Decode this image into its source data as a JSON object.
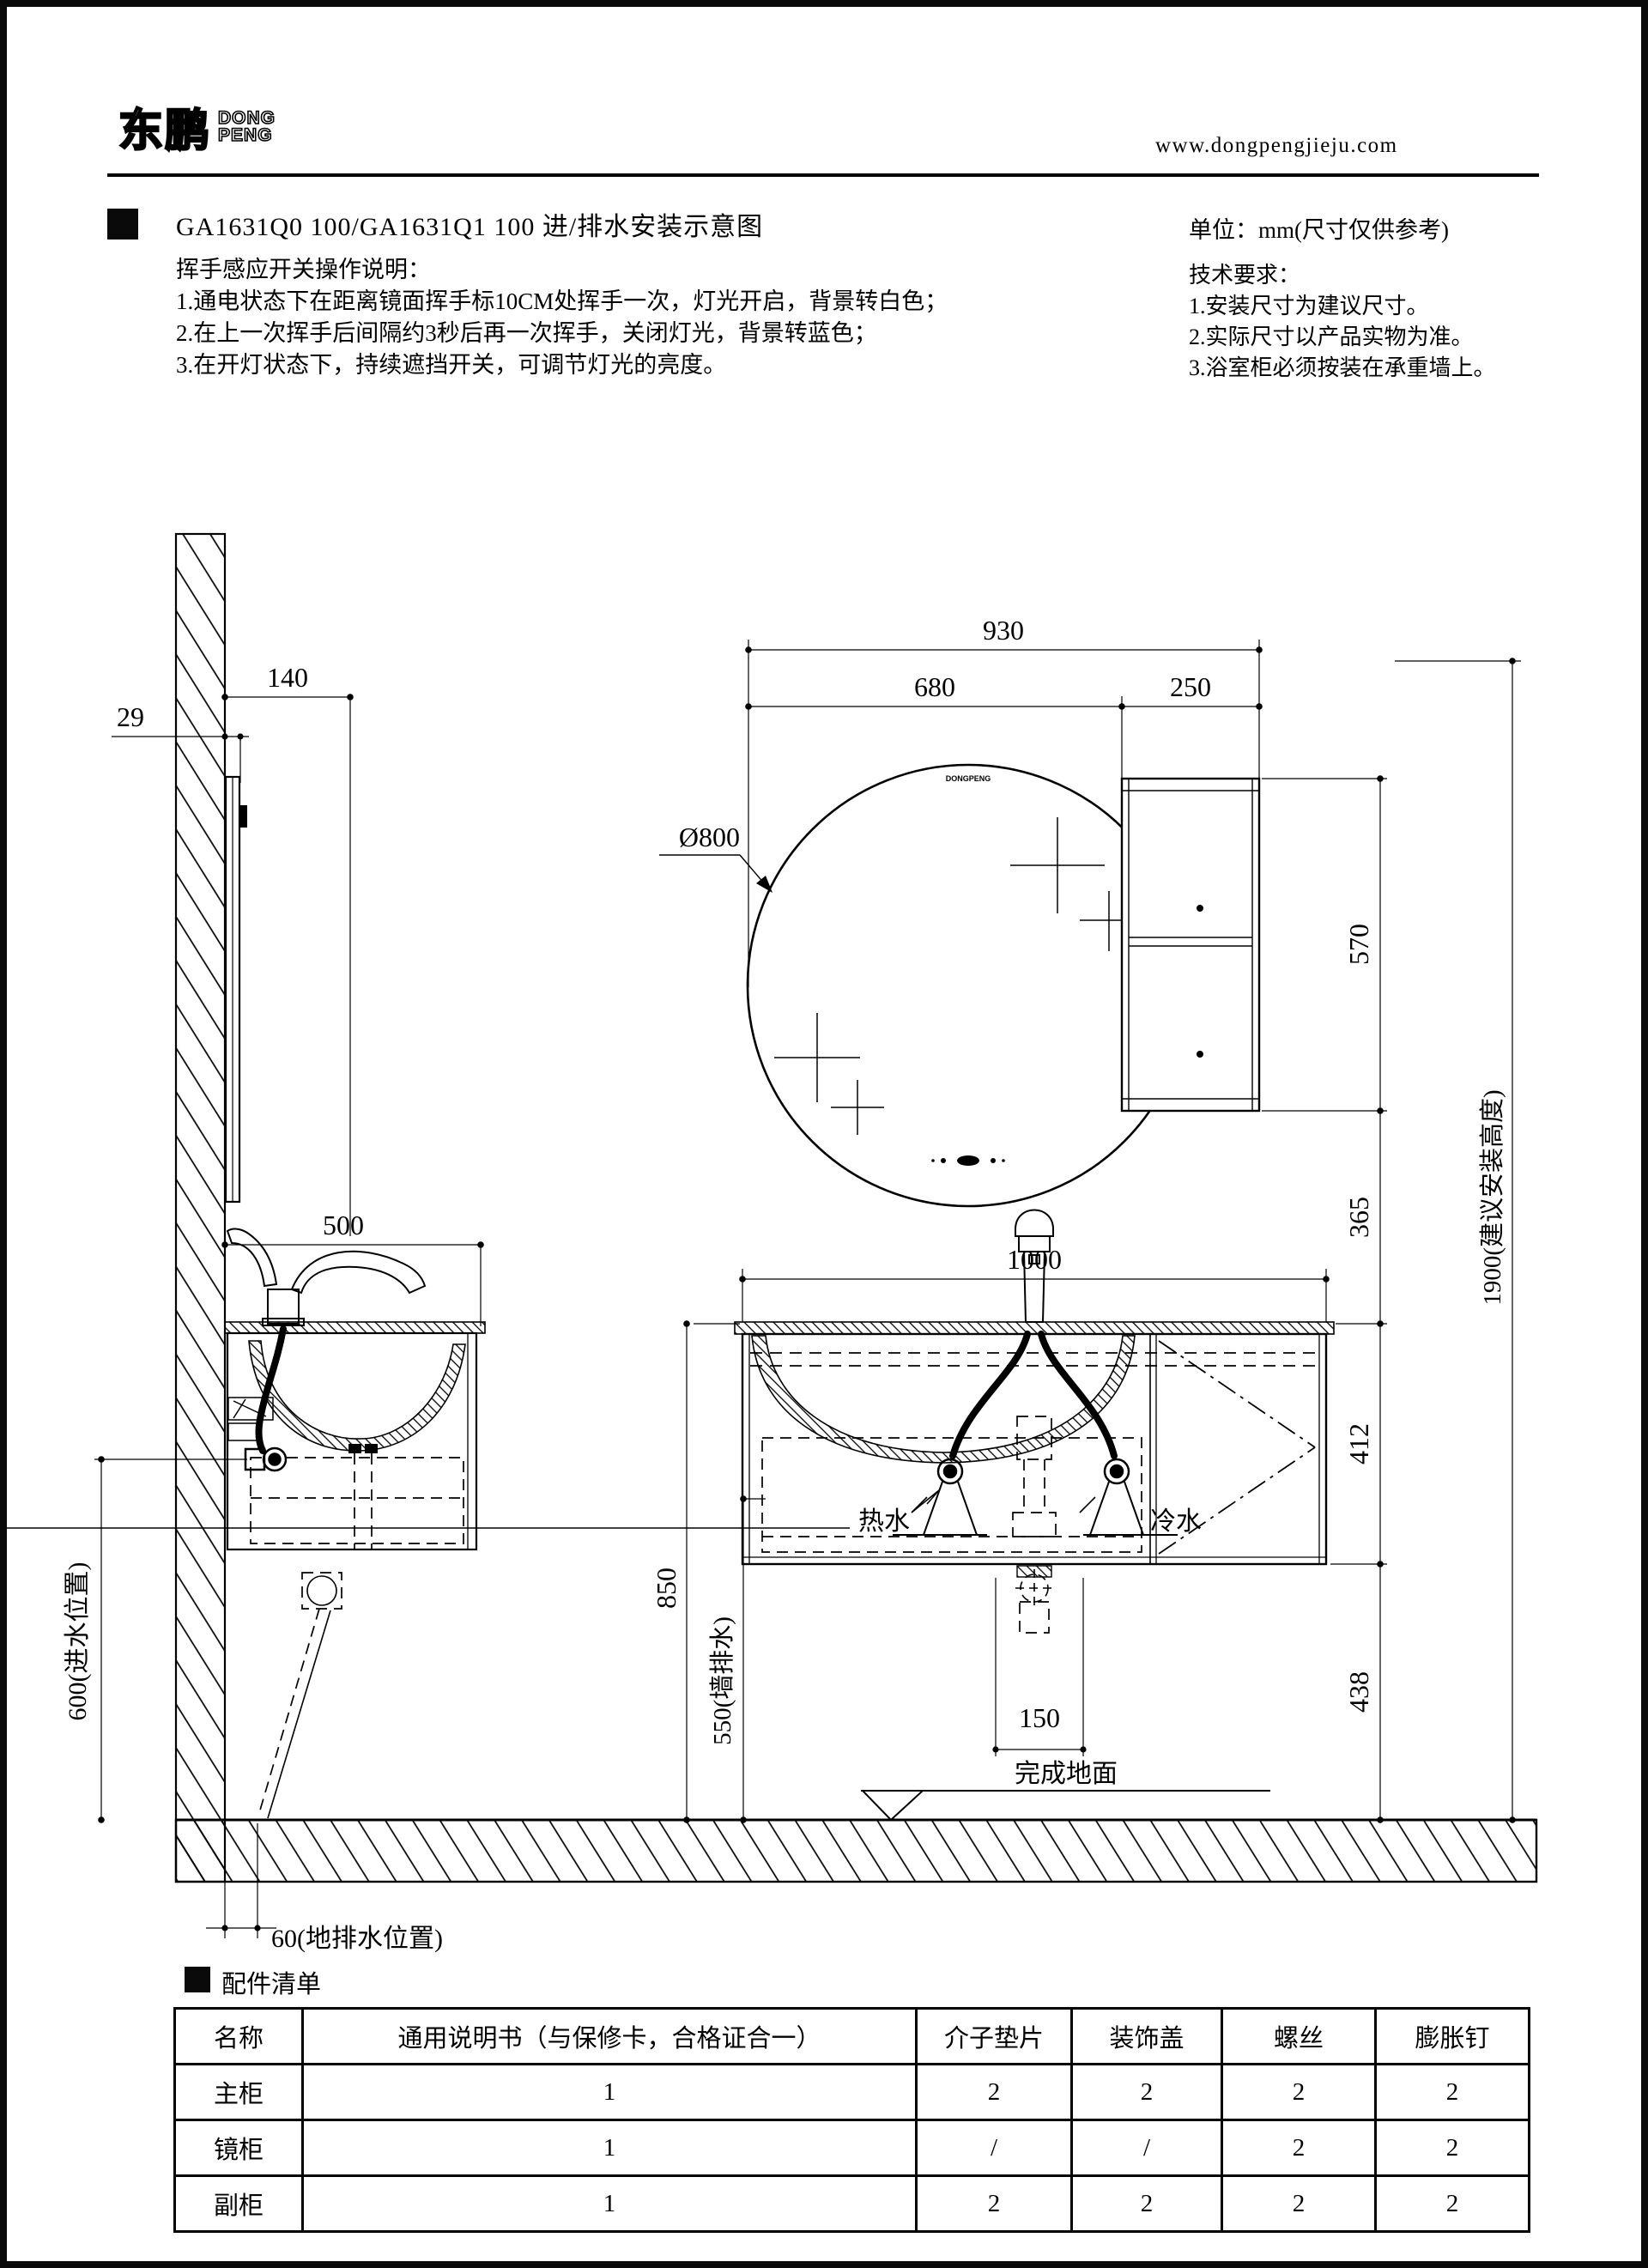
{
  "header": {
    "logo_cn": "东鹏",
    "logo_en_top": "DONG",
    "logo_en_bottom": "PENG",
    "website": "www.dongpengjieju.com"
  },
  "title": "GA1631Q0 100/GA1631Q1 100  进/排水安装示意图",
  "instructions": {
    "heading": "挥手感应开关操作说明：",
    "item1": "1.通电状态下在距离镜面挥手标10CM处挥手一次，灯光开启，背景转白色；",
    "item2": "2.在上一次挥手后间隔约3秒后再一次挥手，关闭灯光，背景转蓝色；",
    "item3": "3.在开灯状态下，持续遮挡开关，可调节灯光的亮度。"
  },
  "notes": {
    "unit": "单位：mm(尺寸仅供参考)",
    "tech_heading": "技术要求：",
    "item1": "1.安装尺寸为建议尺寸。",
    "item2": "2.实际尺寸以产品实物为准。",
    "item3": "3.浴室柜必须按装在承重墙上。"
  },
  "drawing": {
    "dim_140": "140",
    "dim_29": "29",
    "dim_500": "500",
    "dim_600": "600(进水位置)",
    "dim_60": "60(地排水位置)",
    "dim_930": "930",
    "dim_680": "680",
    "dim_250": "250",
    "dia_800": "Ø800",
    "dim_570": "570",
    "dim_365": "365",
    "dim_412": "412",
    "dim_438": "438",
    "dim_1900": "1900(建议安装高度)",
    "dim_1000": "1000",
    "dim_850": "850",
    "dim_550": "550(墙排水)",
    "dim_150": "150",
    "hot_water": "热水",
    "cold_water": "冷水",
    "finished_floor": "完成地面",
    "mirror_logo": "DONGPENG"
  },
  "parts": {
    "section_title": "配件清单",
    "headers": [
      "名称",
      "通用说明书（与保修卡，合格证合一）",
      "介子垫片",
      "装饰盖",
      "螺丝",
      "膨胀钉"
    ],
    "rows": [
      {
        "name": "主柜",
        "values": [
          "1",
          "2",
          "2",
          "2",
          "2"
        ]
      },
      {
        "name": "镜柜",
        "values": [
          "1",
          "/",
          "/",
          "2",
          "2"
        ]
      },
      {
        "name": "副柜",
        "values": [
          "1",
          "2",
          "2",
          "2",
          "2"
        ]
      }
    ]
  }
}
